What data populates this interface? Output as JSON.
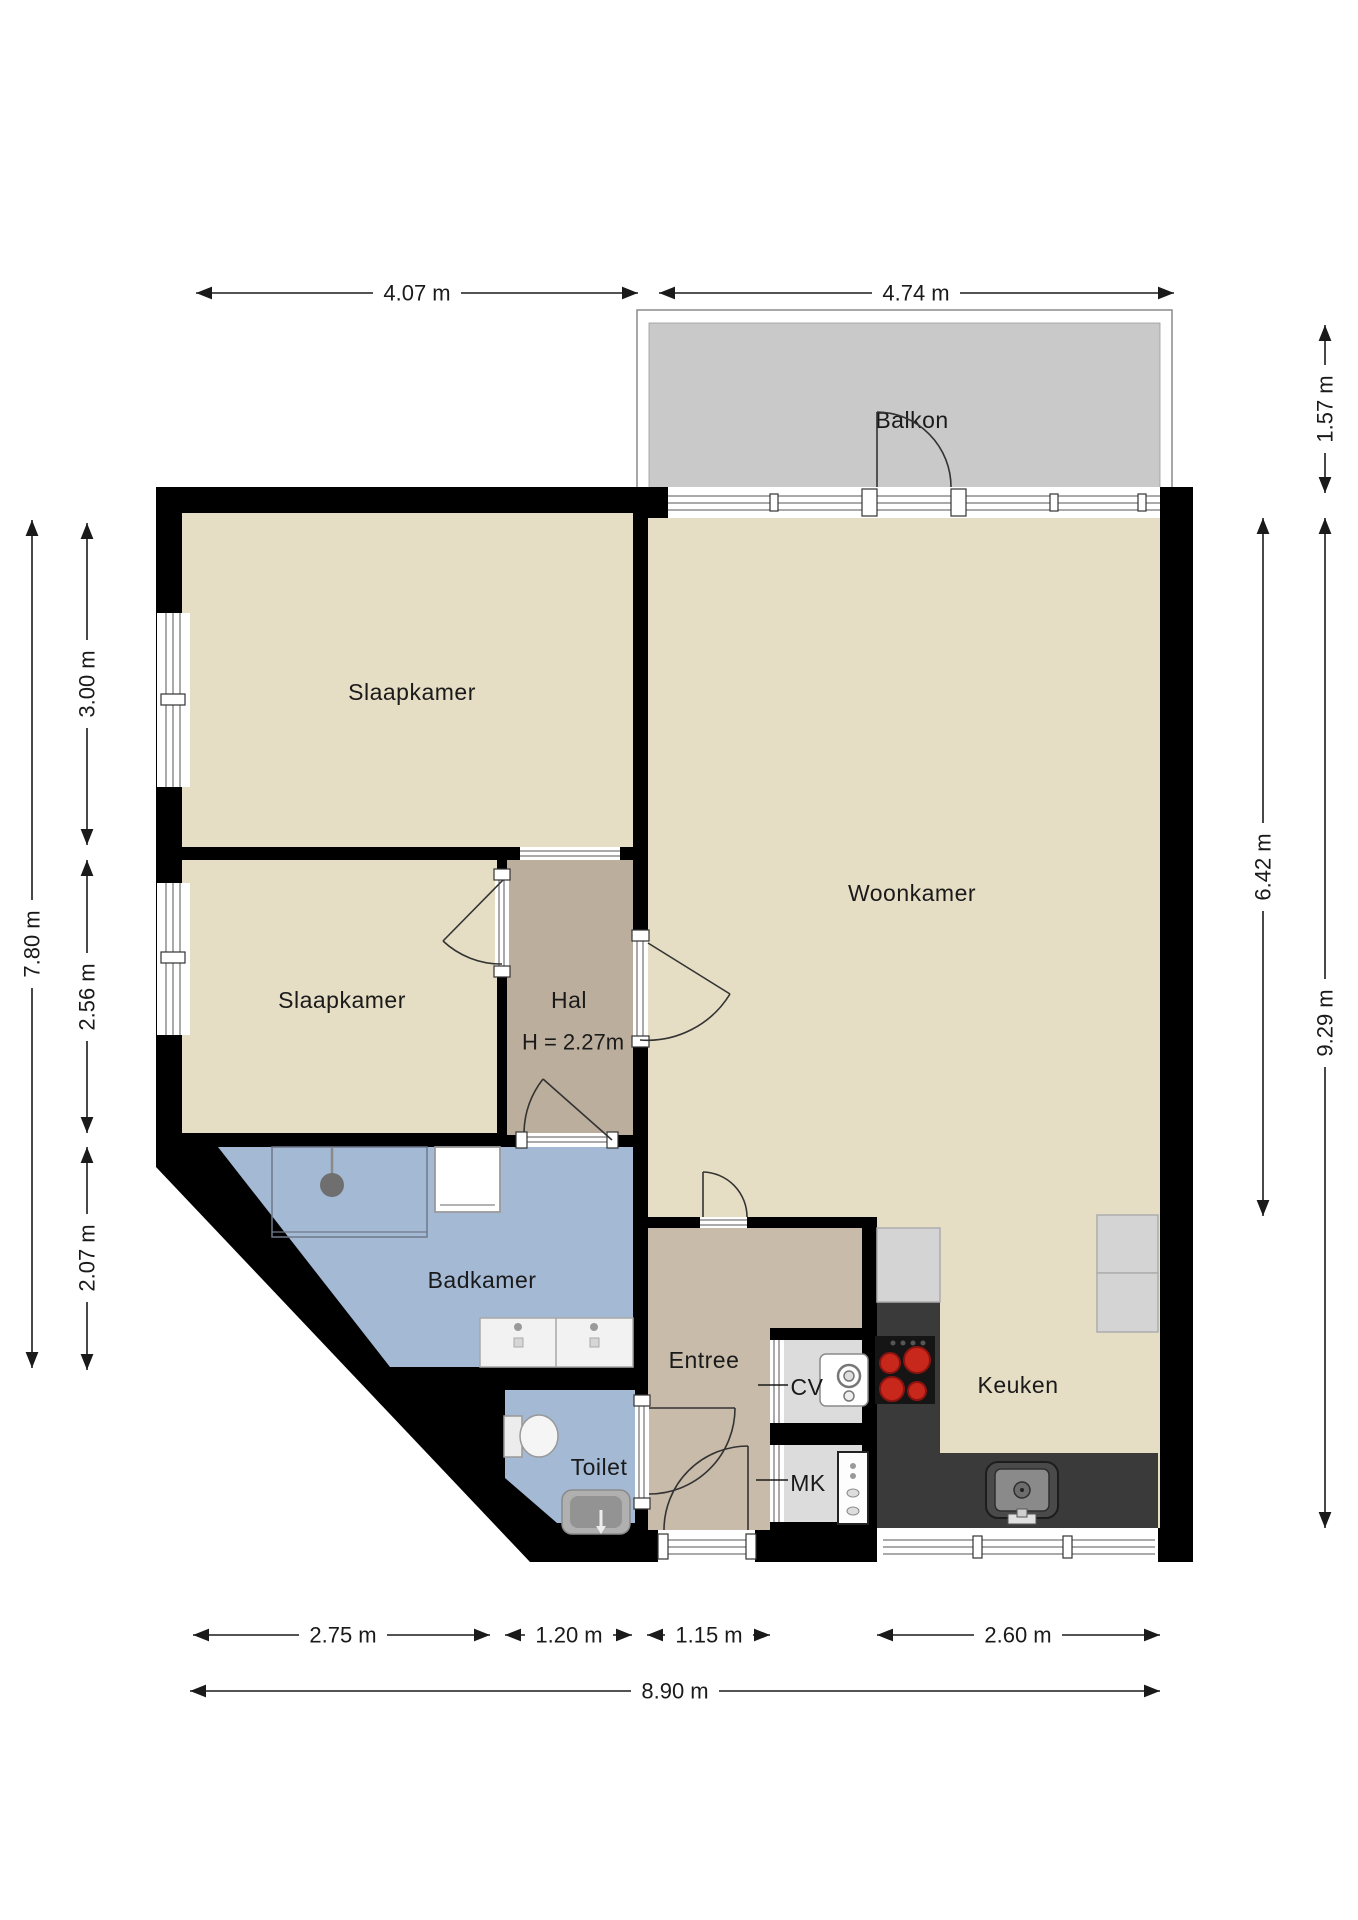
{
  "plan": {
    "type": "floorplan",
    "rooms": {
      "balkon": {
        "label": "Balkon"
      },
      "slaapkamer1": {
        "label": "Slaapkamer"
      },
      "slaapkamer2": {
        "label": "Slaapkamer"
      },
      "woonkamer": {
        "label": "Woonkamer"
      },
      "hal": {
        "label": "Hal",
        "note": "H = 2.27m"
      },
      "badkamer": {
        "label": "Badkamer"
      },
      "toilet": {
        "label": "Toilet"
      },
      "entree": {
        "label": "Entree"
      },
      "cv": {
        "label": "CV"
      },
      "mk": {
        "label": "MK"
      },
      "keuken": {
        "label": "Keuken"
      }
    },
    "dims": {
      "top": [
        "4.07 m",
        "4.74 m"
      ],
      "right": [
        "1.57 m",
        "6.42 m",
        "9.29 m"
      ],
      "left": [
        "7.80 m",
        "3.00 m",
        "2.56 m",
        "2.07 m"
      ],
      "bottom": [
        "2.75 m",
        "1.20 m",
        "1.15 m",
        "2.60 m"
      ],
      "total_width": "8.90 m"
    },
    "colors": {
      "wall": "#000000",
      "floor_beige": "#e5ddc4",
      "floor_hal": "#bcae9d",
      "floor_entree": "#c8bbaa",
      "floor_bath": "#a4b9d4",
      "floor_closet": "#dcdcdc",
      "balkon": "#c9c9c9",
      "counter": "#3a3a3a",
      "cabinet": "#d4d4d4",
      "burner_red": "#c8271c"
    }
  }
}
